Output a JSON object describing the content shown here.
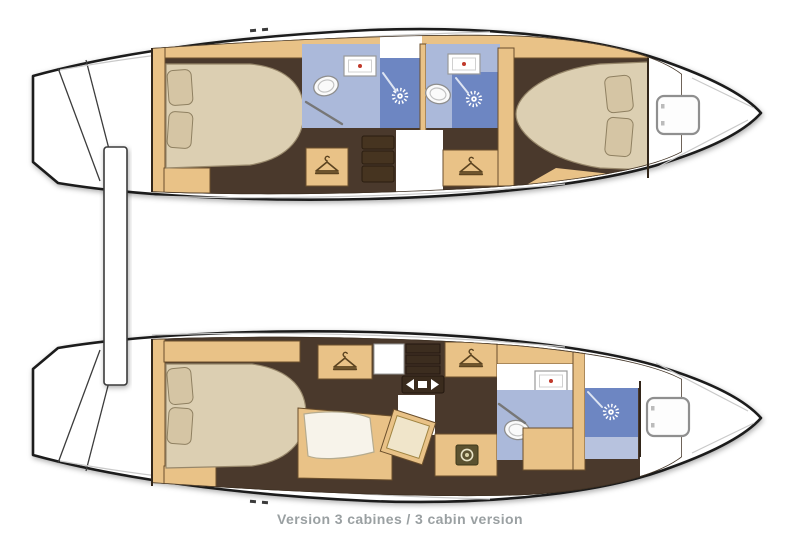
{
  "caption": "Version 3 cabines / 3 cabin version",
  "hulls": {
    "starboard_top": {
      "rooms": [
        "aft double cabin",
        "aft bathroom with shower",
        "companionway stairs",
        "forward bathroom with shower",
        "forward double cabin",
        "bow locker with deck hatch"
      ]
    },
    "port_bottom": {
      "rooms": [
        "aft double cabin",
        "wardrobes",
        "lounge seat with stool and desk",
        "washing machine",
        "bathroom with shower",
        "bow locker with deck hatch"
      ]
    }
  },
  "icons": {
    "wardrobe": "hanger-icon",
    "shower": "sunburst-icon",
    "washing_machine": "drum-icon",
    "sink": "basin-with-red-dot-icon",
    "toilet": "oval-bowl-icon",
    "deck_hatch": "rounded-square-icon",
    "companionway": "left-right-arrows-icon"
  },
  "colors": {
    "hull_outline": "#1c1c1c",
    "deck_white": "#ffffff",
    "floor_dark_wood": "#4a392c",
    "wood_trim": "#e9c287",
    "mattress_beige": "#dccfb2",
    "pillow_beige": "#d5c5a4",
    "bathroom_floor_blue": "#abb9da",
    "shower_blue": "#6d86c2",
    "fixture_white": "#fafafa",
    "faucet_red": "#c0392b",
    "caption_gray": "#9aa0a2"
  }
}
